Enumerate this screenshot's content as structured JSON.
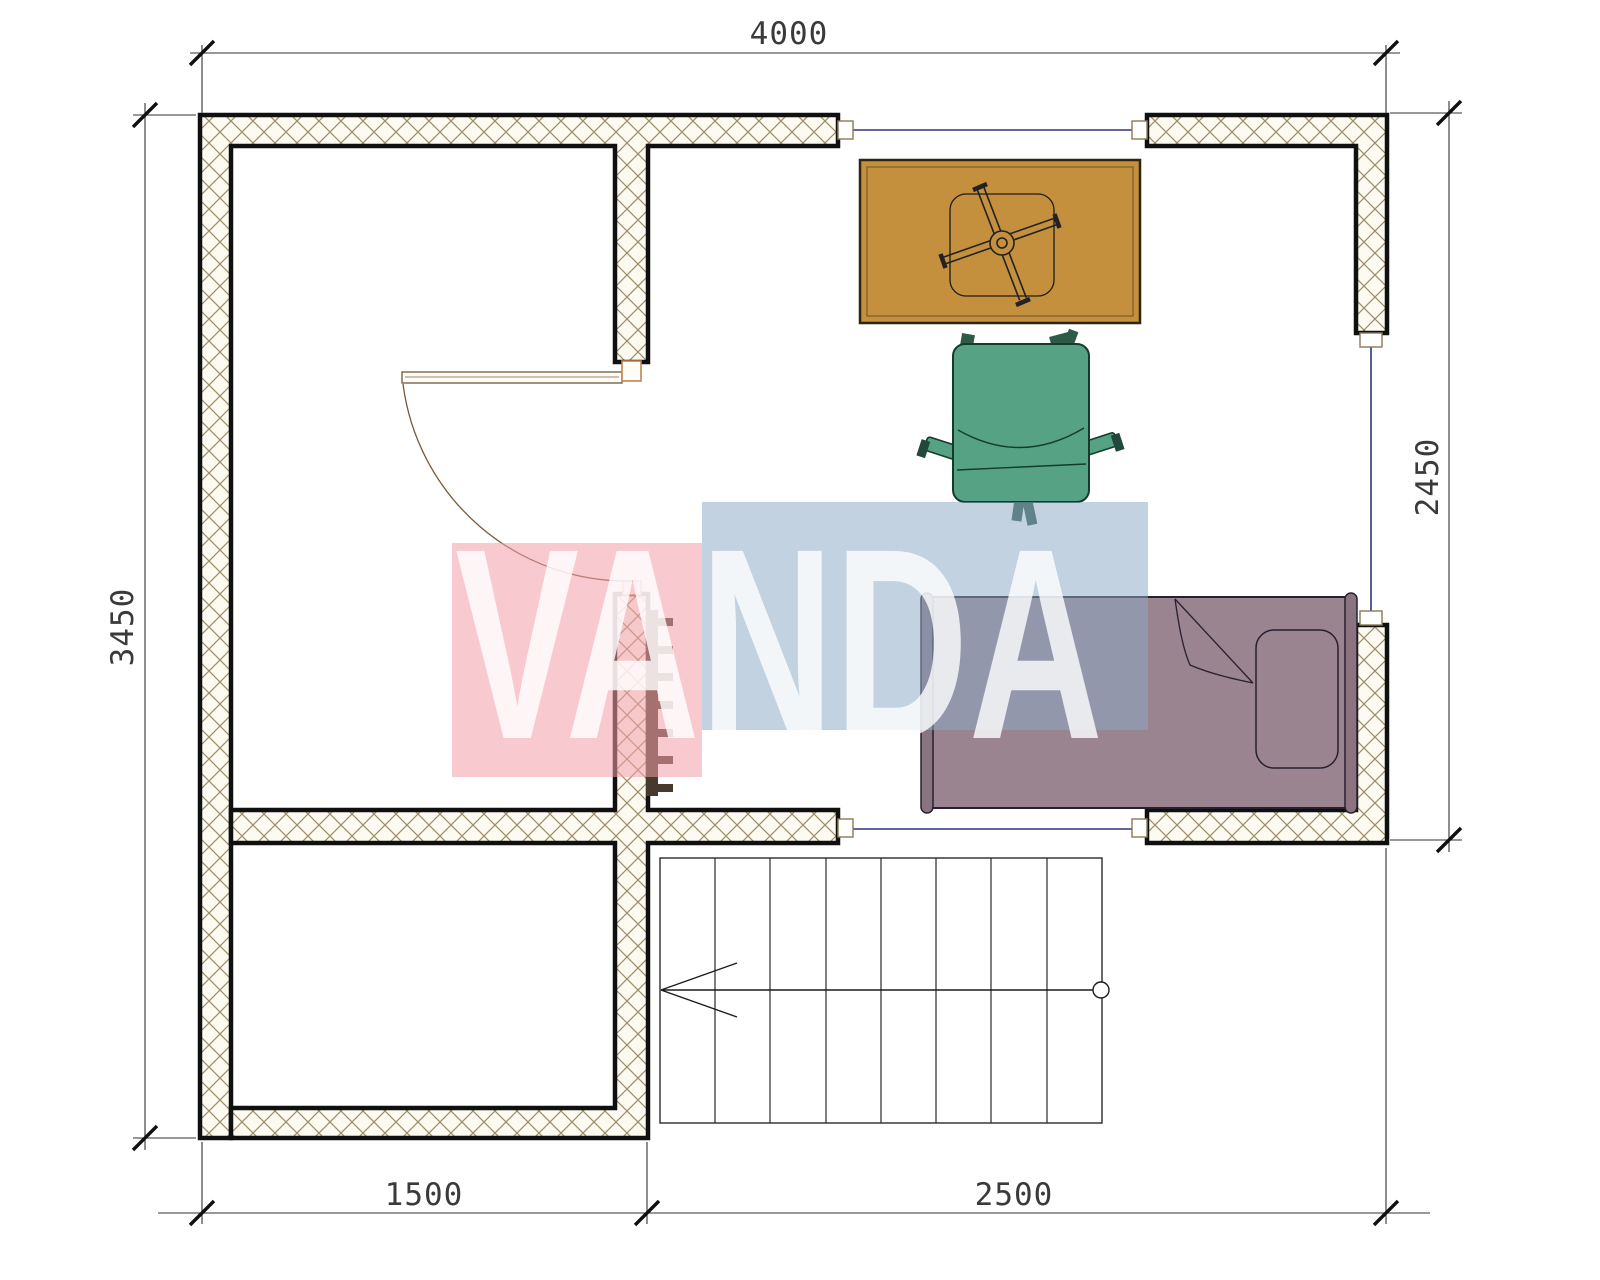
{
  "dimensions": {
    "top": "4000",
    "left": "3450",
    "right": "2450",
    "bottom_left": "1500",
    "bottom_right": "2500"
  },
  "watermark": {
    "text": "VANDA",
    "pink_block_color": "#f8c9d0",
    "blue_block_color": "#c4d3e3"
  },
  "colors": {
    "desk": "#c4903e",
    "chair": "#56a285",
    "chair_dark": "#2e5b48",
    "bed": "#9a8490",
    "bed_outline": "#262031",
    "glazing_line": "#32327e",
    "hatch_line": "#9b8c66",
    "wall_outline": "#101010",
    "dimension_text": "#3a3a3a",
    "radiator": "#473a2c"
  }
}
